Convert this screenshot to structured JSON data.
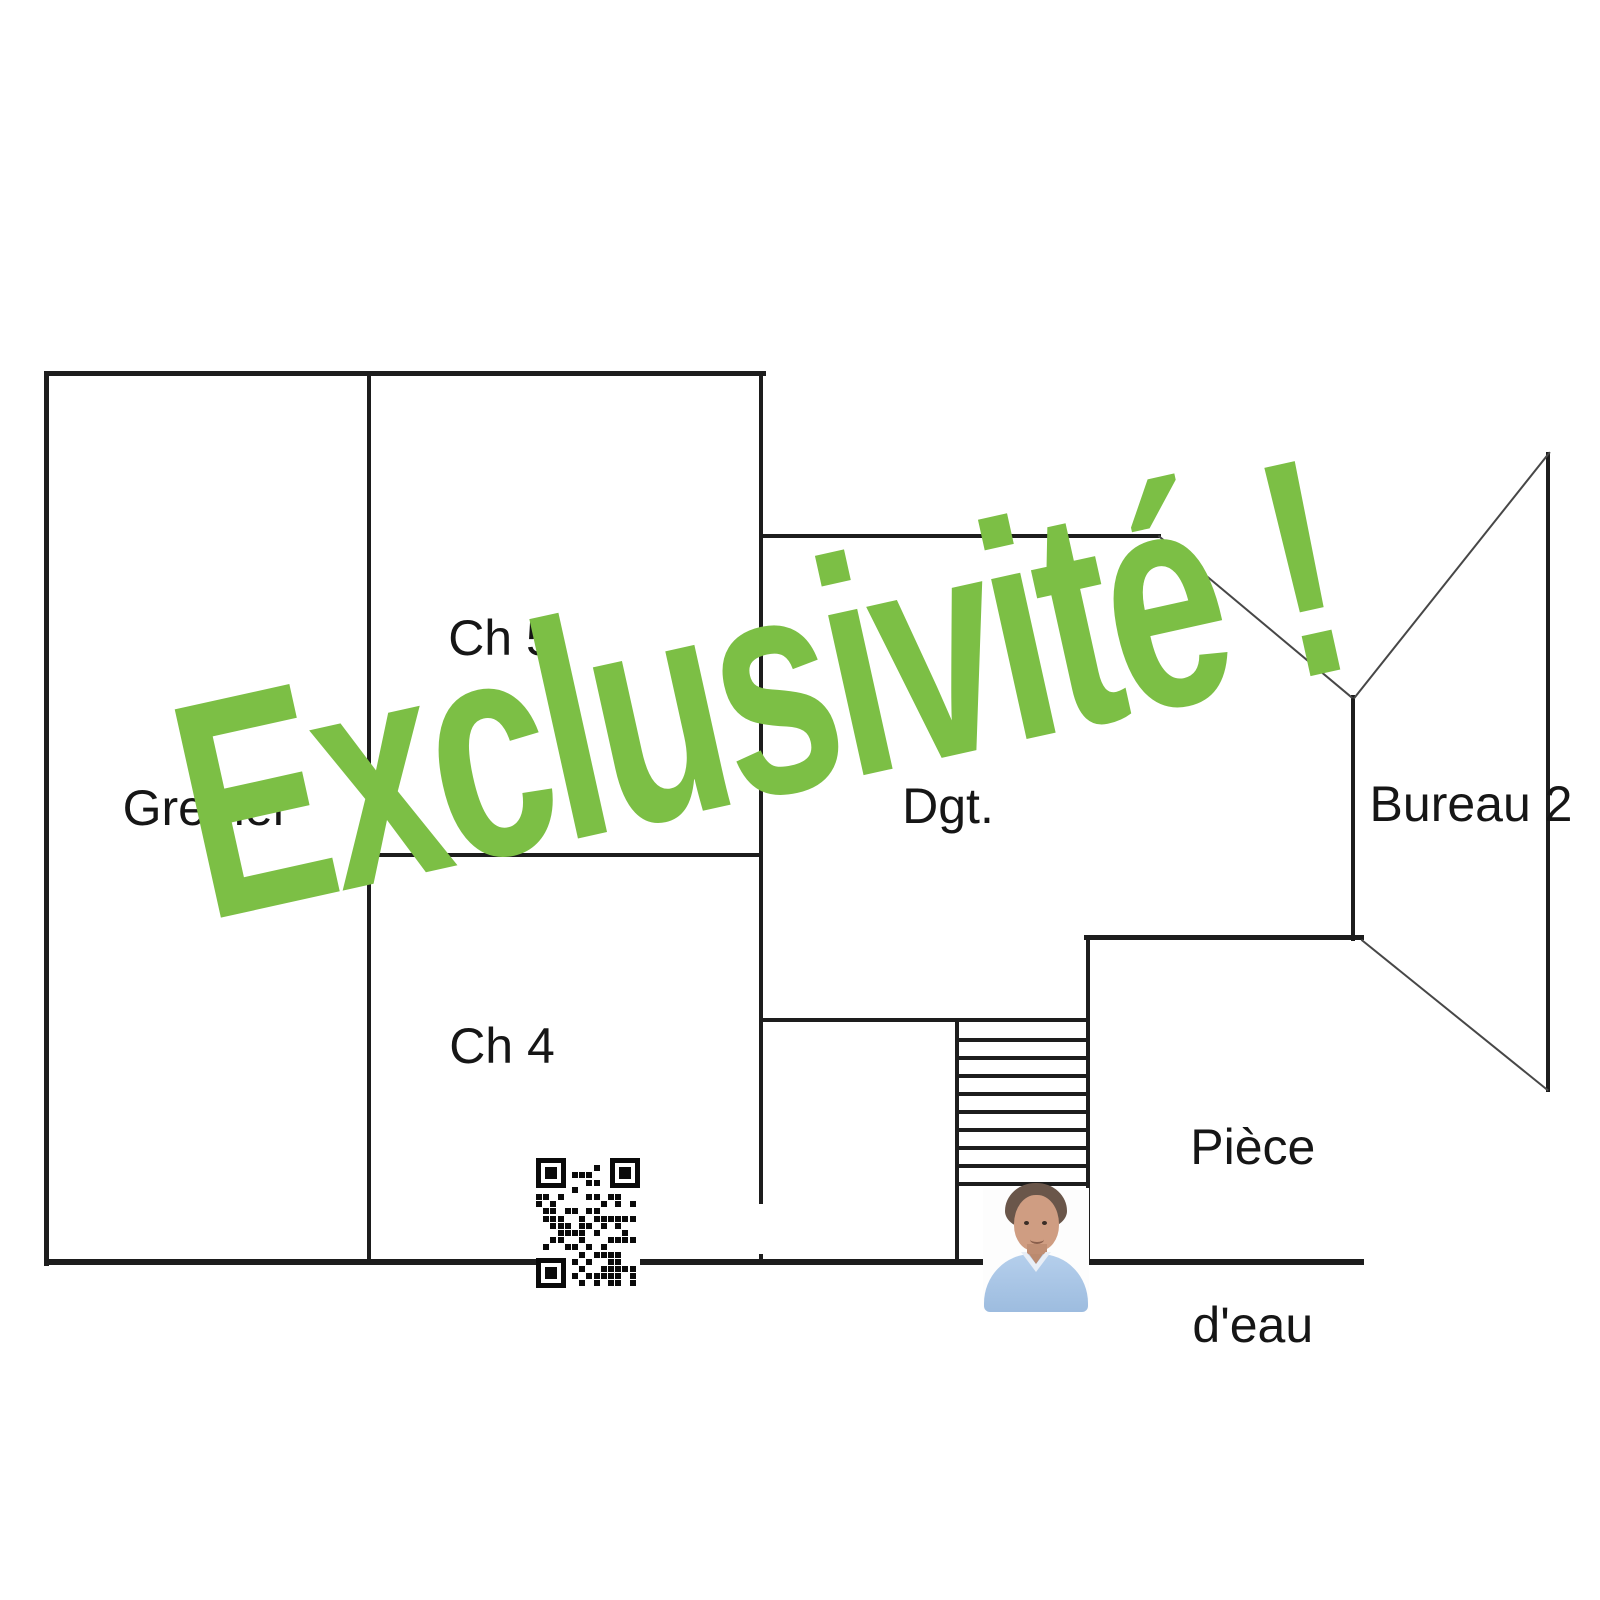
{
  "watermark": {
    "text": "Exclusivité !"
  },
  "rooms": {
    "grenier": {
      "label": "Grenier"
    },
    "ch5": {
      "label": "Ch 5"
    },
    "ch4": {
      "label": "Ch 4"
    },
    "dgt": {
      "label": "Dgt."
    },
    "bureau2": {
      "label": "Bureau 2"
    },
    "piece_eau": {
      "line1": "Pièce",
      "line2": "d'eau"
    }
  },
  "colors": {
    "wall": "#1d1d1d",
    "label_text": "#161616",
    "watermark_green": "#7cbf45",
    "photo_shirt": "#aac7e6",
    "photo_skin": "#cf9d82",
    "photo_hair": "#6a564a"
  }
}
